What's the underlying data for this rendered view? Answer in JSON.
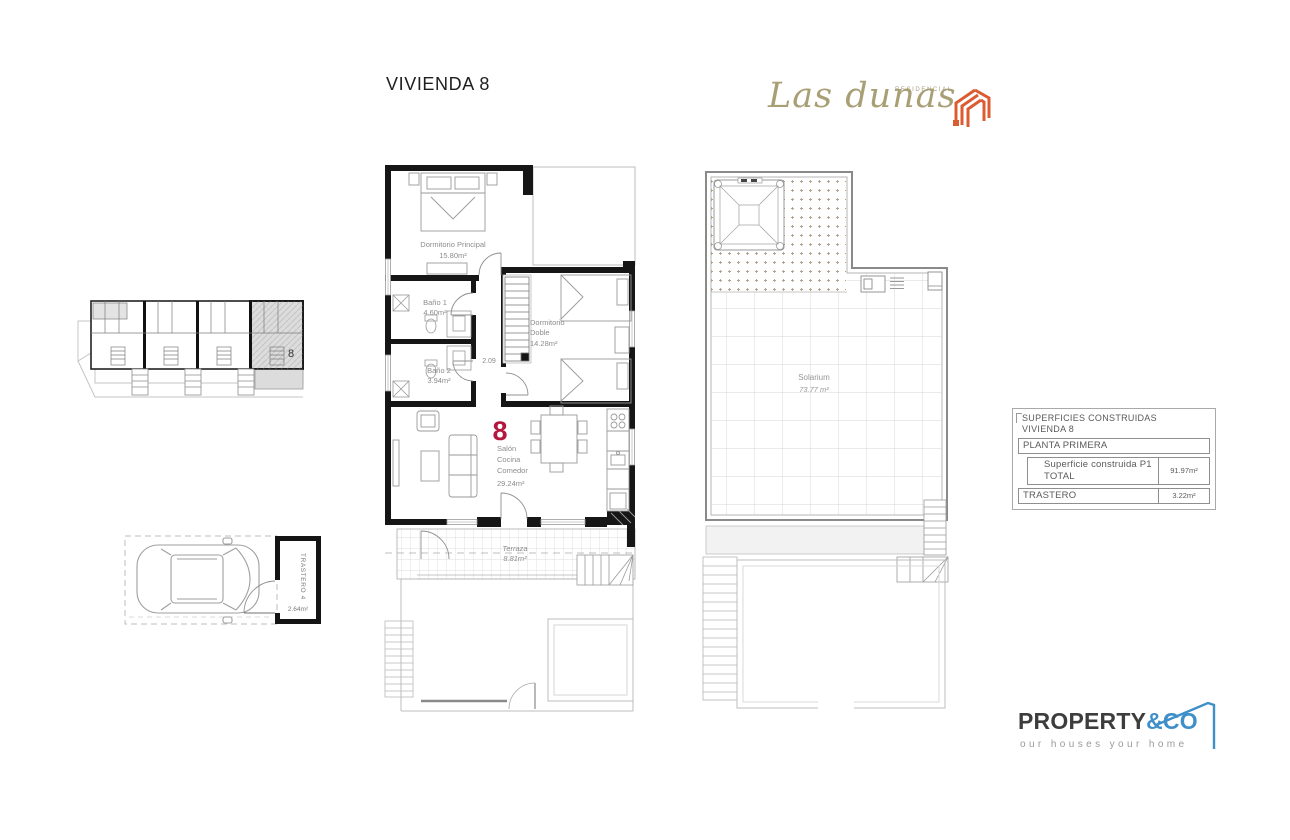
{
  "page": {
    "title": "VIVIENDA 8"
  },
  "brand": {
    "name": "Las dunas",
    "residencial": "RESIDENCIAL",
    "text_color": "#a89f74",
    "icon_color": "#dc5c32",
    "icon": "cube-stripes-icon"
  },
  "key_plan": {
    "unit_number": "8",
    "highlight_color": "#dcdcdc"
  },
  "garage": {
    "trastero_label": "TRASTERO 4",
    "trastero_area": "2.64m²",
    "car": "car-top-view"
  },
  "main_plan": {
    "unit_number": "8",
    "unit_number_color": "#b3173e",
    "dimension": "2.09",
    "rooms": {
      "principal": {
        "name": "Dormitorio Principal",
        "area": "15.80m²"
      },
      "bano1": {
        "name": "Baño 1",
        "area": "4.60m²"
      },
      "bano2": {
        "name": "Baño 2",
        "area": "3.94m²"
      },
      "doble": {
        "name_line1": "Dormitorio",
        "name_line2": "Doble",
        "area": "14.28m²"
      },
      "salon": {
        "name_line1": "Salón",
        "name_line2": "Cocina",
        "name_line3": "Comedor",
        "area": "29.24m²"
      },
      "terraza": {
        "name": "Terraza",
        "area": "8.81m²"
      }
    }
  },
  "roof_plan": {
    "solarium": {
      "name": "Solarium",
      "area": "73.77 m²"
    }
  },
  "summary_table": {
    "title_line1": "SUPERFICIES CONSTRUIDAS",
    "title_line2": "VIVIENDA 8",
    "row1_label": "PLANTA PRIMERA",
    "row2_label": "Superficie construida P1 TOTAL",
    "row2_value": "91.97m²",
    "row3_label": "TRASTERO",
    "row3_value": "3.22m²"
  },
  "footer_brand": {
    "name_primary": "PROPERTY",
    "name_secondary": "&CO",
    "secondary_color": "#3f8fc9",
    "tagline": "our houses your home"
  }
}
